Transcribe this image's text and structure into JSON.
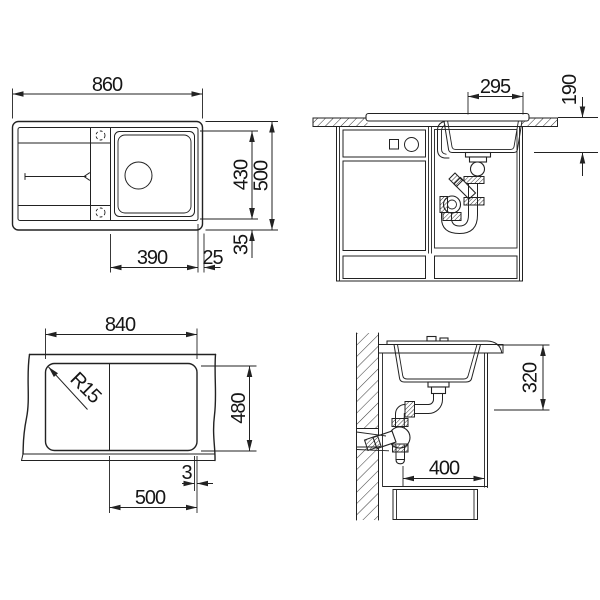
{
  "drawing": {
    "title": "Sink installation technical drawing",
    "views": {
      "top": {
        "dim_overall_width": "860",
        "dim_inner_depth": "430",
        "dim_overall_depth": "500",
        "dim_bowl_width": "390",
        "dim_bowl_to_edge": "25",
        "dim_rim_bottom": "35"
      },
      "front": {
        "dim_bowl_width": "295",
        "dim_bowl_depth": "190"
      },
      "cutout": {
        "dim_cutout_width": "840",
        "dim_cutout_depth": "480",
        "dim_corner_radius": "R15",
        "dim_divider": "3",
        "dim_bowl_offset": "500"
      },
      "side": {
        "dim_clearance_depth": "320",
        "dim_cabinet_depth": "400"
      }
    }
  }
}
